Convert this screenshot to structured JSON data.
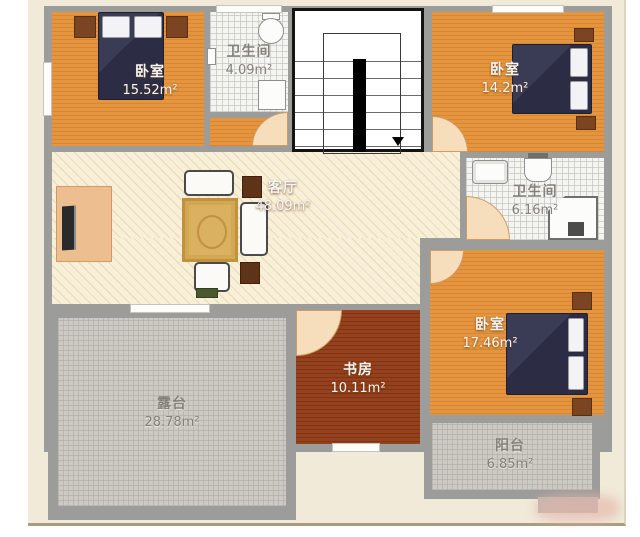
{
  "plan_title": "二层户型图",
  "rooms": {
    "b1": {
      "name": "卧室",
      "area": "15.52m²"
    },
    "bath1": {
      "name": "卫生间",
      "area": "4.09m²"
    },
    "b2": {
      "name": "卧室",
      "area": "14.2m²"
    },
    "living": {
      "name": "客厅",
      "area": "48.09m²"
    },
    "bath2": {
      "name": "卫生间",
      "area": "6.16m²"
    },
    "b3": {
      "name": "卧室",
      "area": "17.46m²"
    },
    "study": {
      "name": "书房",
      "area": "10.11m²"
    },
    "terrace": {
      "name": "露台",
      "area": "28.78m²"
    },
    "balcony": {
      "name": "阳台",
      "area": "6.85m²"
    }
  },
  "colors": {
    "wall": "#9c9c9a",
    "wood_floor": "#e0913f",
    "study_floor": "#8a3a1c",
    "living_floor": "#f8efd8",
    "bath_tile": "#f4f4f1",
    "outdoor_tile": "#cdcac3",
    "bed": "#30314a",
    "nightstand": "#7a4520",
    "paper": "#f1ead8"
  }
}
